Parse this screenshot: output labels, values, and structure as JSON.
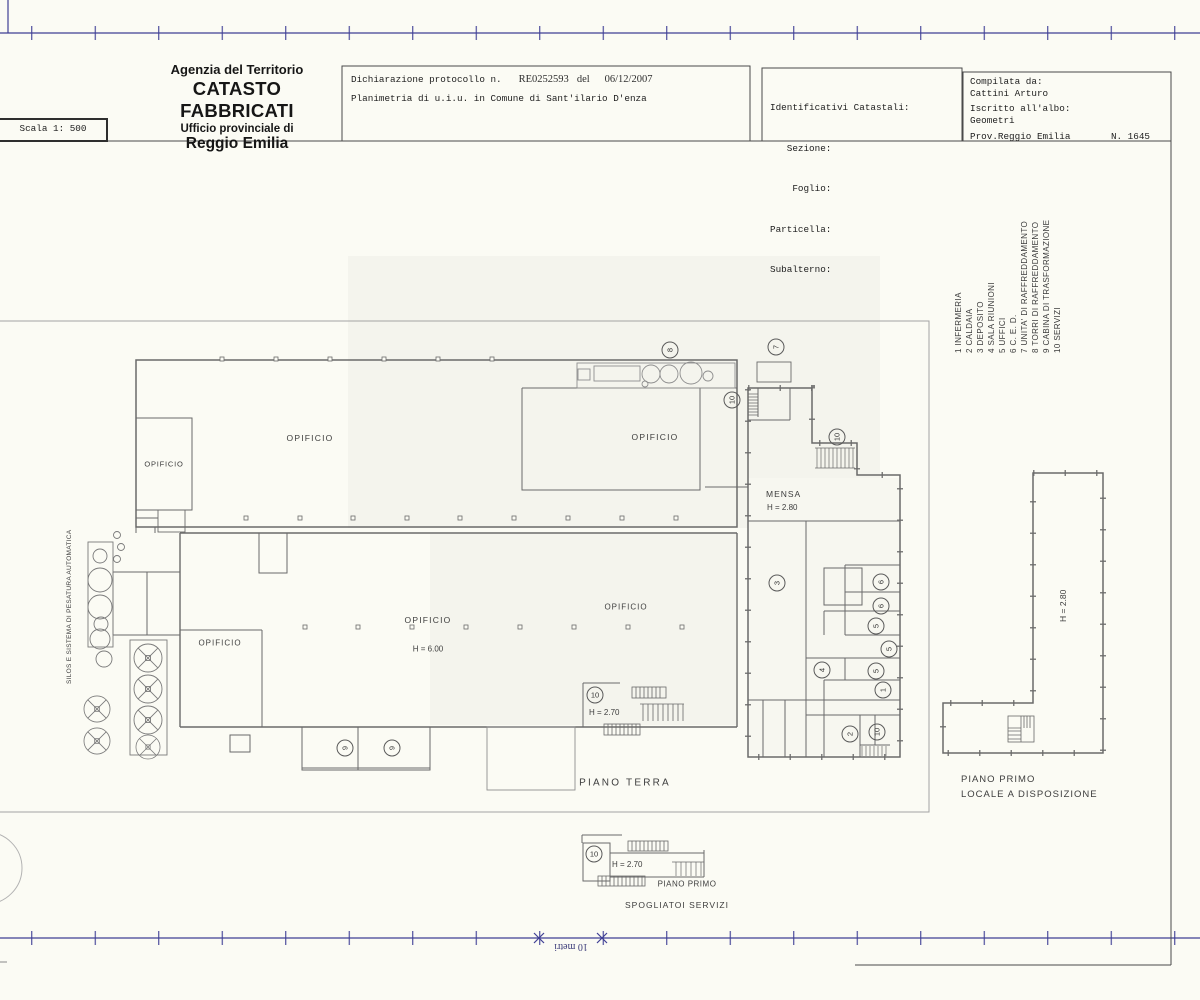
{
  "header": {
    "agency_line1": "Agenzia del Territorio",
    "agency_line2": "CATASTO FABBRICATI",
    "agency_line3": "Ufficio provinciale di",
    "agency_line4": "Reggio Emilia",
    "scale_label": "Scala 1: 500",
    "declaration_label": "Dichiarazione protocollo n.",
    "declaration_protocol": "RE0252593",
    "declaration_del": "del",
    "declaration_date": "06/12/2007",
    "declaration_line2": "Planimetria di u.i.u. in Comune di Sant'ilario D'enza",
    "cadastral_title": "Identificativi Catastali:",
    "cadastral_fields": [
      "   Sezione:",
      "    Foglio:",
      "Particella:",
      "Subalterno:"
    ],
    "compiled_title": "Compilata da:",
    "compiled_name": "Cattini Arturo",
    "register_title": "Iscritto all'albo:",
    "register_value": "Geometri",
    "province": "Prov.Reggio Emilia",
    "register_number": "N. 1645"
  },
  "legend": {
    "items": [
      "1 INFERMERIA",
      "2 CALDAIA",
      "3 DEPOSITO",
      "4 SALA RIUNIONI",
      "5 UFFICI",
      "6 C. E. D.",
      "7 UNITA' DI RAFFREDDAMENTO",
      "8 TORRI DI RAFFREDDAMENTO",
      "9 CABINA DI TRASFORMAZIONE",
      "10 SERVIZI"
    ]
  },
  "plan": {
    "labels": {
      "opificio": "OPIFICIO",
      "mensa": "MENSA",
      "mensa_height": "H = 2.80",
      "hall_height": "H = 6.00",
      "stairs_height": "H = 2.70",
      "ground_floor": "PIANO TERRA",
      "first_floor": "PIANO PRIMO",
      "first_floor_use": "LOCALE A DISPOSIZIONE",
      "first_floor_height": "H = 2.80",
      "spogliatoi_height": "H = 2.70",
      "spogliatoi_floor": "PIANO PRIMO",
      "spogliatoi": "SPOGLIATOI SERVIZI",
      "silos": "SILOS E SISTEMA DI PESATURA AUTOMATICA",
      "scale_bar": "10 metri"
    },
    "room_numbers": [
      "8",
      "7",
      "10",
      "10",
      "3",
      "6",
      "6",
      "5",
      "5",
      "5",
      "4",
      "1",
      "2",
      "10",
      "9",
      "9",
      "10",
      "10"
    ]
  }
}
